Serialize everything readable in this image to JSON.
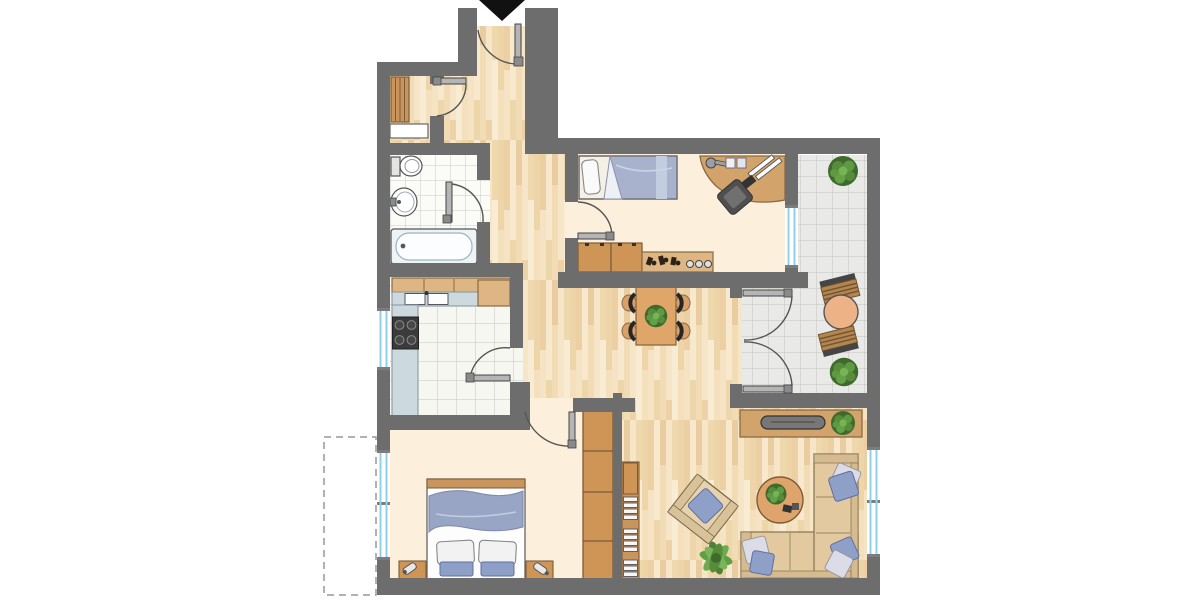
{
  "document": {
    "kind": "apartment floor plan",
    "view": "top-down architectural drawing",
    "text_labels": "none visible"
  },
  "palette": {
    "background": "#ffffff",
    "wall": "#6d6d6d",
    "outline": "#555555",
    "wood_floor_base": "#f3ddb8",
    "room_cream": "#fcefdc",
    "tile_white": "#fbfbf8",
    "tile_grout": "#c9c9c3",
    "balcony_tile": "#e9e9e7",
    "window_glass": "#8fd0e8",
    "door_leaf": "#b5b5b5",
    "door_arc": "#555555",
    "entry_arrow": "#111111",
    "dashed_outline": "#999999",
    "furniture_wood": "#cf9557",
    "furniture_wood_light": "#ddb684",
    "counter_gray": "#ccd9de",
    "appliance_dark": "#3b3b3b",
    "fabric_blue": "#8ea0c8",
    "blanket_blue": "#99a5c5",
    "fabric_white": "#f2f2f2",
    "sofa_beige": "#e3c9a0",
    "plant_green": "#568c3a",
    "plant_dark": "#3e6b2d",
    "tv_gray": "#777777",
    "terrace_table": "#eeb287"
  },
  "rooms": [
    {
      "id": "entry-hall",
      "name": "entry hall",
      "floor": "wood planks"
    },
    {
      "id": "storage-closet",
      "name": "storage closet",
      "floor": "wood planks",
      "contents": [
        "slatted shelf rack",
        "white dresser"
      ]
    },
    {
      "id": "bathroom",
      "name": "bathroom",
      "floor": "white tile",
      "contents": [
        "toilet",
        "washbasin",
        "bathtub"
      ]
    },
    {
      "id": "kitchen",
      "name": "kitchen",
      "floor": "white tile",
      "contents": [
        "upper counter",
        "double sink counter",
        "corner counter",
        "cooktop counter"
      ]
    },
    {
      "id": "bedroom-top",
      "name": "bedroom / office",
      "floor": "cream",
      "contents": [
        "single bed",
        "corner desk",
        "desk lamp",
        "office chair",
        "sideboard with clutter"
      ]
    },
    {
      "id": "dining-hall",
      "name": "open hall / dining area",
      "floor": "wood planks",
      "contents": [
        "dining table",
        "4 chairs",
        "plant centerpiece"
      ]
    },
    {
      "id": "balcony",
      "name": "balcony",
      "floor": "gray tile",
      "contents": [
        "bistro table",
        "2 slatted chairs",
        "2 potted plants"
      ]
    },
    {
      "id": "living-room",
      "name": "living room",
      "floor": "wood planks",
      "contents": [
        "tv lowboard",
        "tv",
        "plant",
        "corner sofa",
        "5 pillows",
        "round coffee table",
        "armchair",
        "bookshelf",
        "floor plant"
      ]
    },
    {
      "id": "bedroom-bottom",
      "name": "bedroom",
      "floor": "cream",
      "contents": [
        "double bed",
        "2 pillows",
        "blanket",
        "2 nightstands with lamps",
        "wardrobe"
      ]
    }
  ],
  "openings": {
    "entry": "top of plan, marked with black arrow pointing in",
    "doors": [
      "entry door",
      "storage closet door",
      "bathroom door",
      "kitchen door",
      "bedroom-top door",
      "bedroom-bottom door",
      "double french door to balcony"
    ],
    "windows": [
      "kitchen left wall",
      "bedroom-bottom left wall",
      "bedroom-top right wall",
      "living room right wall"
    ]
  },
  "annotations": {
    "dashed_outline": "dashed rectangle at lower left outside exterior wall"
  }
}
